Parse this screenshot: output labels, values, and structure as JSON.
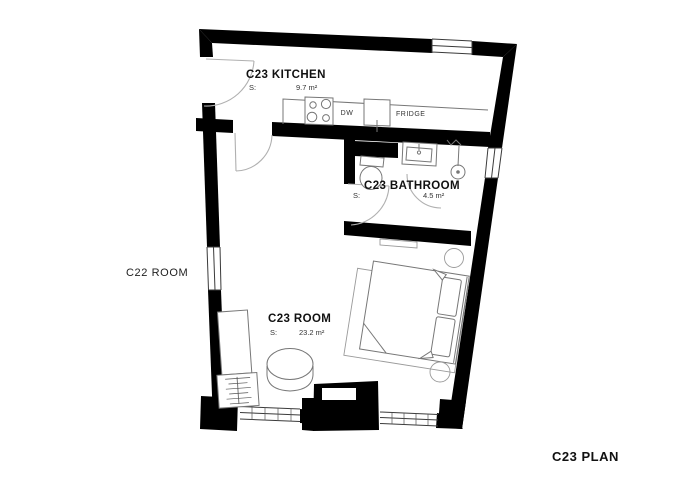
{
  "plan": {
    "title": "C23 PLAN",
    "adjacent_room": "C22 ROOM",
    "rooms": [
      {
        "name": "C23 KITCHEN",
        "area_label": "S:",
        "area": "9.7 m²"
      },
      {
        "name": "C23 BATHROOM",
        "area_label": "S:",
        "area": "4.5 m²"
      },
      {
        "name": "C23 ROOM",
        "area_label": "S:",
        "area": "23.2 m²"
      }
    ],
    "appliances": {
      "dishwasher": "DW",
      "fridge": "FRIDGE"
    },
    "colors": {
      "wall": "#000000",
      "furniture_line": "#777777",
      "background": "#ffffff",
      "text": "#111111"
    }
  }
}
